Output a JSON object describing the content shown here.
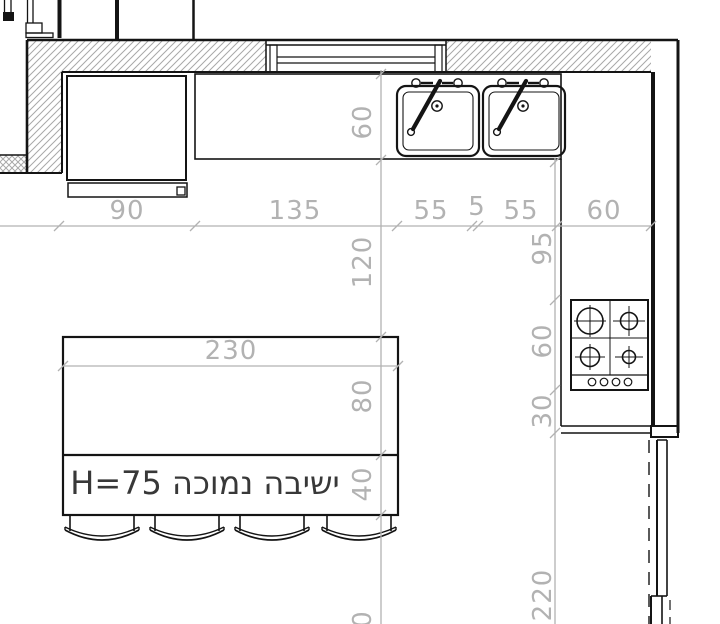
{
  "colors": {
    "line": "#141414",
    "dim_gray": "#b2b2b2",
    "hatch_gray": "#a8a8a8",
    "label_dark": "#383838",
    "background": "#ffffff"
  },
  "island": {
    "label": "ישיבה נמוכה H=75",
    "width_dim": "230"
  },
  "dims": {
    "top": {
      "d90": "90",
      "d135": "135",
      "d55a": "55",
      "d5": "5",
      "d55b": "55",
      "d60": "60"
    },
    "left": {
      "d60": "60",
      "d120": "120",
      "d80": "80",
      "d40": "40",
      "partial0": "0"
    },
    "right": {
      "d95": "95",
      "d60": "60",
      "d30": "30",
      "d220": "220"
    }
  }
}
